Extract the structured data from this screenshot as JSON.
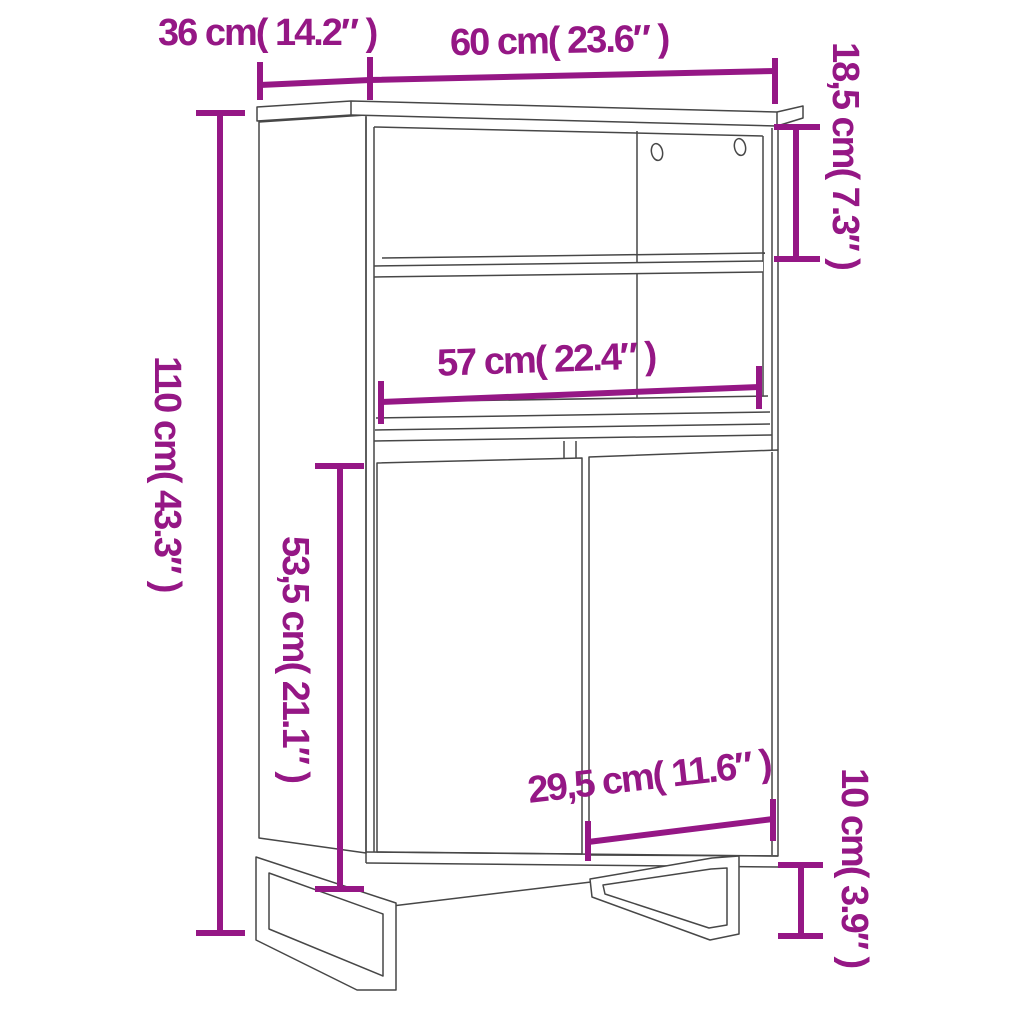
{
  "diagram": {
    "type": "furniture-dimension-diagram",
    "subject": "highboard cabinet with two open shelves, two doors and U-shaped metal legs",
    "background_color": "#ffffff",
    "line_color": "#474747",
    "accent_color": "#951785",
    "dimensions": {
      "depth": "36 cm( 14.2″ )",
      "width": "60 cm( 23.6″ )",
      "top_compartment_height": "18,5 cm( 7.3″ )",
      "total_height": "110 cm( 43.3″ )",
      "inner_width": "57 cm( 22.4″ )",
      "door_section_height": "53,5 cm( 21.1″ )",
      "door_width": "29,5 cm( 11.6″ )",
      "leg_height": "10 cm( 3.9″ )"
    }
  }
}
